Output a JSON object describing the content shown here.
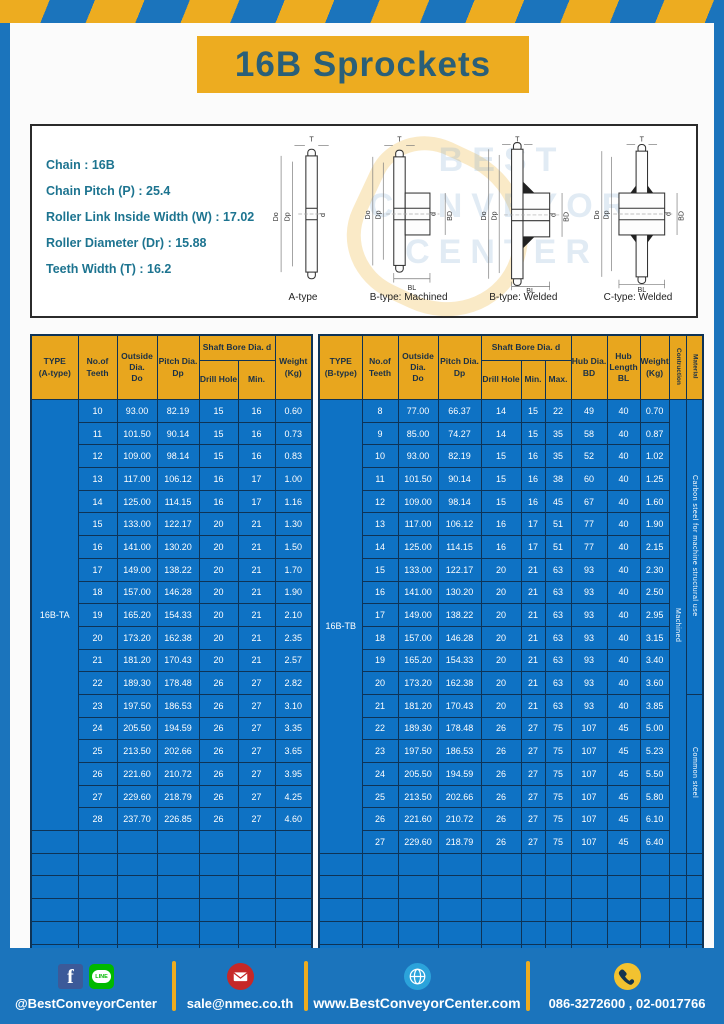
{
  "page_title": "16B Sprockets",
  "colors": {
    "frame_blue": "#1B74BC",
    "stripe_yellow": "#EDAC20",
    "table_header_yellow": "#E8A61E",
    "cell_blue": "#0E72C4",
    "border_navy": "#0E3356",
    "title_teal": "#2A5F78",
    "spec_text_teal": "#1D7490"
  },
  "specs": [
    {
      "label": "Chain",
      "value": "16B"
    },
    {
      "label": "Chain Pitch (P)",
      "value": "25.4"
    },
    {
      "label": "Roller Link Inside Width (W)",
      "value": "17.02"
    },
    {
      "label": "Roller Diameter (Dr)",
      "value": "15.88"
    },
    {
      "label": "Teeth Width (T)",
      "value": "16.2"
    }
  ],
  "watermark": "BEST\nCONVEYOR\nCENTER",
  "diagram": {
    "labels": [
      "A-type",
      "B-type: Machined",
      "B-type: Welded",
      "C-type: Welded"
    ],
    "dims": {
      "t": "T",
      "outside": "Do",
      "pitch": "Dp",
      "bore": "d",
      "hub_dia": "BD",
      "hub_len": "BL"
    }
  },
  "table_a": {
    "name": "table-a-type",
    "col_widths": [
      47,
      39,
      40,
      42,
      39,
      37,
      37
    ],
    "columns_before": [
      "TYPE\n(A-type)",
      "No.of\nTeeth",
      "Outside\nDia.\nDo",
      "Pitch Dia.\nDp"
    ],
    "group_header": "Shaft Bore Dia. d",
    "sub_columns": [
      "Drill Hole",
      "Min."
    ],
    "columns_after": [
      "Weight\n(Kg)"
    ],
    "type_label": "16B-TA",
    "rows": [
      [
        "10",
        "93.00",
        "82.19",
        "15",
        "16",
        "0.60"
      ],
      [
        "11",
        "101.50",
        "90.14",
        "15",
        "16",
        "0.73"
      ],
      [
        "12",
        "109.00",
        "98.14",
        "15",
        "16",
        "0.83"
      ],
      [
        "13",
        "117.00",
        "106.12",
        "16",
        "17",
        "1.00"
      ],
      [
        "14",
        "125.00",
        "114.15",
        "16",
        "17",
        "1.16"
      ],
      [
        "15",
        "133.00",
        "122.17",
        "20",
        "21",
        "1.30"
      ],
      [
        "16",
        "141.00",
        "130.20",
        "20",
        "21",
        "1.50"
      ],
      [
        "17",
        "149.00",
        "138.22",
        "20",
        "21",
        "1.70"
      ],
      [
        "18",
        "157.00",
        "146.28",
        "20",
        "21",
        "1.90"
      ],
      [
        "19",
        "165.20",
        "154.33",
        "20",
        "21",
        "2.10"
      ],
      [
        "20",
        "173.20",
        "162.38",
        "20",
        "21",
        "2.35"
      ],
      [
        "21",
        "181.20",
        "170.43",
        "20",
        "21",
        "2.57"
      ],
      [
        "22",
        "189.30",
        "178.48",
        "26",
        "27",
        "2.82"
      ],
      [
        "23",
        "197.50",
        "186.53",
        "26",
        "27",
        "3.10"
      ],
      [
        "24",
        "205.50",
        "194.59",
        "26",
        "27",
        "3.35"
      ],
      [
        "25",
        "213.50",
        "202.66",
        "26",
        "27",
        "3.65"
      ],
      [
        "26",
        "221.60",
        "210.72",
        "26",
        "27",
        "3.95"
      ],
      [
        "27",
        "229.60",
        "218.79",
        "26",
        "27",
        "4.25"
      ],
      [
        "28",
        "237.70",
        "226.85",
        "26",
        "27",
        "4.60"
      ]
    ],
    "empty_rows": 6
  },
  "table_b": {
    "name": "table-b-type",
    "col_widths": [
      43,
      36,
      40,
      43,
      40,
      24,
      26,
      36,
      33,
      29,
      17,
      17
    ],
    "columns_before": [
      "TYPE\n(B-type)",
      "No.of\nTeeth",
      "Outside\nDia.\nDo",
      "Pitch Dia.\nDp"
    ],
    "group_header": "Shaft Bore Dia. d",
    "sub_columns": [
      "Drill Hole",
      "Min.",
      "Max."
    ],
    "columns_after": [
      "Hub Dia.\nBD",
      "Hub\nLength\nBL",
      "Weight\n(Kg)"
    ],
    "vertical_columns": [
      "Contruction",
      "Material"
    ],
    "type_label": "16B-TB",
    "construction_label": "Machined",
    "material_segments": [
      {
        "label": "Carbon steel for machine structural use",
        "row_count": 13
      },
      {
        "label": "Common steel",
        "row_count": 7
      }
    ],
    "rows": [
      [
        "8",
        "77.00",
        "66.37",
        "14",
        "15",
        "22",
        "49",
        "40",
        "0.70"
      ],
      [
        "9",
        "85.00",
        "74.27",
        "14",
        "15",
        "35",
        "58",
        "40",
        "0.87"
      ],
      [
        "10",
        "93.00",
        "82.19",
        "15",
        "16",
        "35",
        "52",
        "40",
        "1.02"
      ],
      [
        "11",
        "101.50",
        "90.14",
        "15",
        "16",
        "38",
        "60",
        "40",
        "1.25"
      ],
      [
        "12",
        "109.00",
        "98.14",
        "15",
        "16",
        "45",
        "67",
        "40",
        "1.60"
      ],
      [
        "13",
        "117.00",
        "106.12",
        "16",
        "17",
        "51",
        "77",
        "40",
        "1.90"
      ],
      [
        "14",
        "125.00",
        "114.15",
        "16",
        "17",
        "51",
        "77",
        "40",
        "2.15"
      ],
      [
        "15",
        "133.00",
        "122.17",
        "20",
        "21",
        "63",
        "93",
        "40",
        "2.30"
      ],
      [
        "16",
        "141.00",
        "130.20",
        "20",
        "21",
        "63",
        "93",
        "40",
        "2.50"
      ],
      [
        "17",
        "149.00",
        "138.22",
        "20",
        "21",
        "63",
        "93",
        "40",
        "2.95"
      ],
      [
        "18",
        "157.00",
        "146.28",
        "20",
        "21",
        "63",
        "93",
        "40",
        "3.15"
      ],
      [
        "19",
        "165.20",
        "154.33",
        "20",
        "21",
        "63",
        "93",
        "40",
        "3.40"
      ],
      [
        "20",
        "173.20",
        "162.38",
        "20",
        "21",
        "63",
        "93",
        "40",
        "3.60"
      ],
      [
        "21",
        "181.20",
        "170.43",
        "20",
        "21",
        "63",
        "93",
        "40",
        "3.85"
      ],
      [
        "22",
        "189.30",
        "178.48",
        "26",
        "27",
        "75",
        "107",
        "45",
        "5.00"
      ],
      [
        "23",
        "197.50",
        "186.53",
        "26",
        "27",
        "75",
        "107",
        "45",
        "5.23"
      ],
      [
        "24",
        "205.50",
        "194.59",
        "26",
        "27",
        "75",
        "107",
        "45",
        "5.50"
      ],
      [
        "25",
        "213.50",
        "202.66",
        "26",
        "27",
        "75",
        "107",
        "45",
        "5.80"
      ],
      [
        "26",
        "221.60",
        "210.72",
        "26",
        "27",
        "75",
        "107",
        "45",
        "6.10"
      ],
      [
        "27",
        "229.60",
        "218.79",
        "26",
        "27",
        "75",
        "107",
        "45",
        "6.40"
      ]
    ],
    "empty_rows": 5
  },
  "footer": {
    "social": {
      "handle": "@BestConveyorCenter",
      "facebook_glyph": "f",
      "line_label": "LINE"
    },
    "email": {
      "address": "sale@nmec.co.th"
    },
    "website": {
      "url": "www.BestConveyorCenter.com"
    },
    "phone": {
      "numbers": "086-3272600 , 02-0017766"
    }
  }
}
